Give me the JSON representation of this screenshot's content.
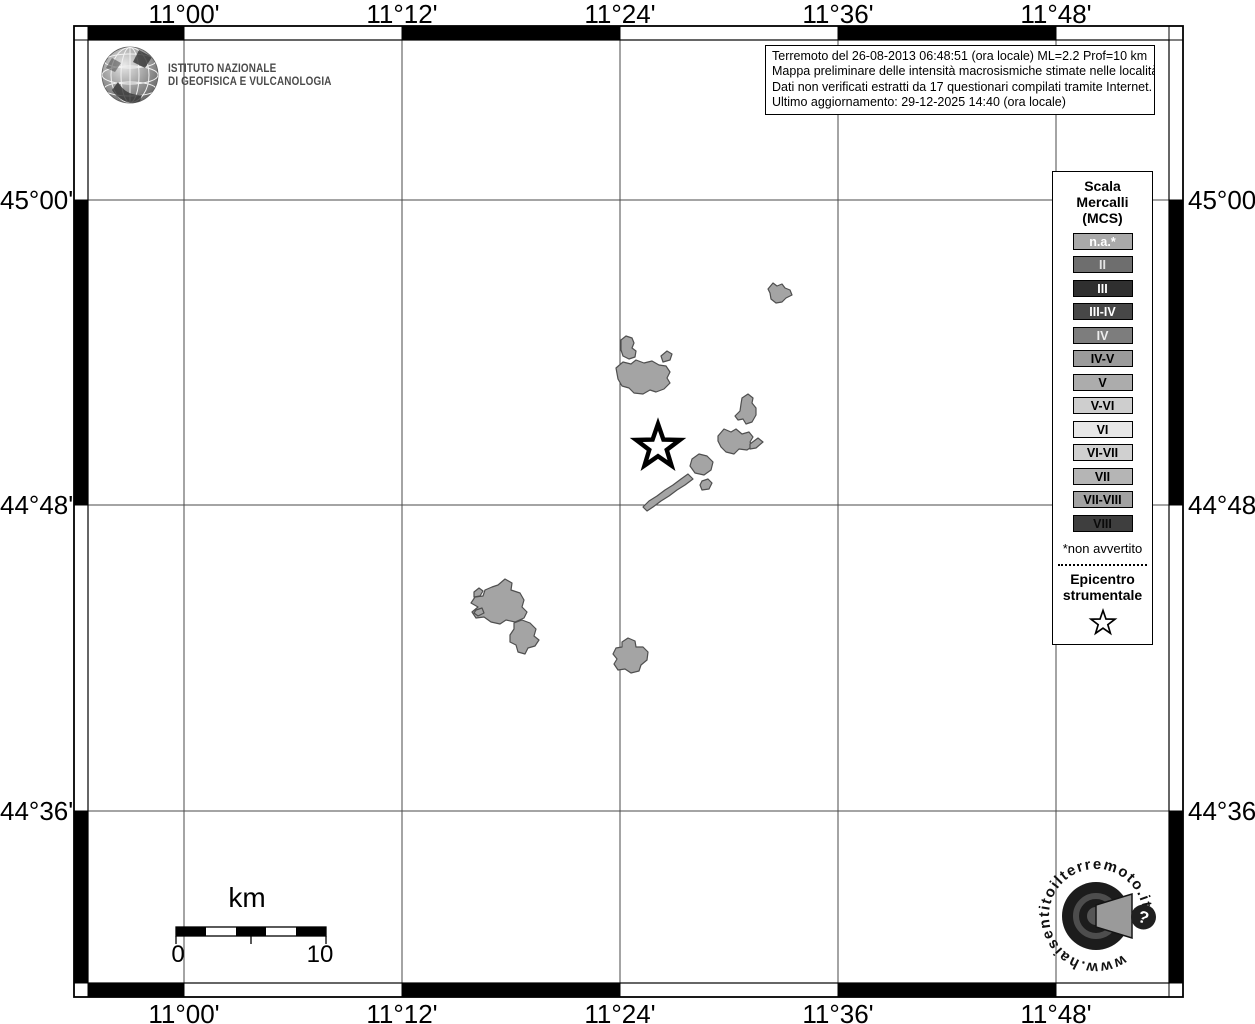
{
  "header": {
    "ingv": {
      "lines": [
        "ISTITUTO NAZIONALE",
        "DI GEOFISICA E VULCANOLOGIA"
      ]
    }
  },
  "info_box": {
    "lines": [
      "Terremoto del 26-08-2013 06:48:51 (ora locale) ML=2.2 Prof=10 km",
      "Mappa preliminare delle intensità macrosismiche stimate nelle località",
      "Dati non verificati estratti da 17 questionari compilati tramite Internet.",
      "Ultimo aggiornamento: 29-12-2025 14:40 (ora locale)"
    ]
  },
  "axes": {
    "top": [
      "11°00'",
      "11°12'",
      "11°24'",
      "11°36'",
      "11°48'"
    ],
    "bottom": [
      "11°00'",
      "11°12'",
      "11°24'",
      "11°36'",
      "11°48'"
    ],
    "left": [
      "45°00'",
      "44°48'",
      "44°36'"
    ],
    "right": [
      "45°00'",
      "44°48'",
      "44°36'"
    ]
  },
  "legend": {
    "title_lines": [
      "Scala",
      "Mercalli",
      "(MCS)"
    ],
    "items": [
      {
        "label": "n.a.*",
        "color": "#a9a9a9",
        "text_color": "#ffffff"
      },
      {
        "label": "II",
        "color": "#6e6e6e",
        "text_color": "#e3e3e3"
      },
      {
        "label": "III",
        "color": "#2f2f2f",
        "text_color": "#ffffff"
      },
      {
        "label": "III-IV",
        "color": "#474747",
        "text_color": "#ffffff"
      },
      {
        "label": "IV",
        "color": "#7d7d7d",
        "text_color": "#ededed"
      },
      {
        "label": "IV-V",
        "color": "#9b9b9b",
        "text_color": "#000000"
      },
      {
        "label": "V",
        "color": "#acacac",
        "text_color": "#000000"
      },
      {
        "label": "V-VI",
        "color": "#cecece",
        "text_color": "#000000"
      },
      {
        "label": "VI",
        "color": "#e7e7e7",
        "text_color": "#000000"
      },
      {
        "label": "VI-VII",
        "color": "#d0d0d0",
        "text_color": "#000000"
      },
      {
        "label": "VII",
        "color": "#b5b5b5",
        "text_color": "#000000"
      },
      {
        "label": "VII-VIII",
        "color": "#a2a2a2",
        "text_color": "#000000"
      },
      {
        "label": "VIII",
        "color": "#3e3e3e",
        "text_color": "#0a0a0a"
      }
    ],
    "footnote": "*non avvertito",
    "epicenter_lines": [
      "Epicentro",
      "strumentale"
    ]
  },
  "scale_bar": {
    "unit_label": "km",
    "min_label": "0",
    "max_label": "10"
  },
  "watermark": {
    "url_text": "www.haisentitoilterremoto.it",
    "badge": "?"
  },
  "map": {
    "locality_fill": "#a4a4a4",
    "locality_outline": "#4f4f4f",
    "epicenter_fill": "#ffffff",
    "epicenter_outline": "#000000",
    "grid_color": "#4a4a4a",
    "frame_color": "#000000"
  },
  "icons": {
    "epicenter": "star-outline-icon",
    "ingv_logo": "globe-wireframe-icon",
    "watermark_logo": "seismo-dial-icon",
    "badge": "question-mark-icon"
  }
}
